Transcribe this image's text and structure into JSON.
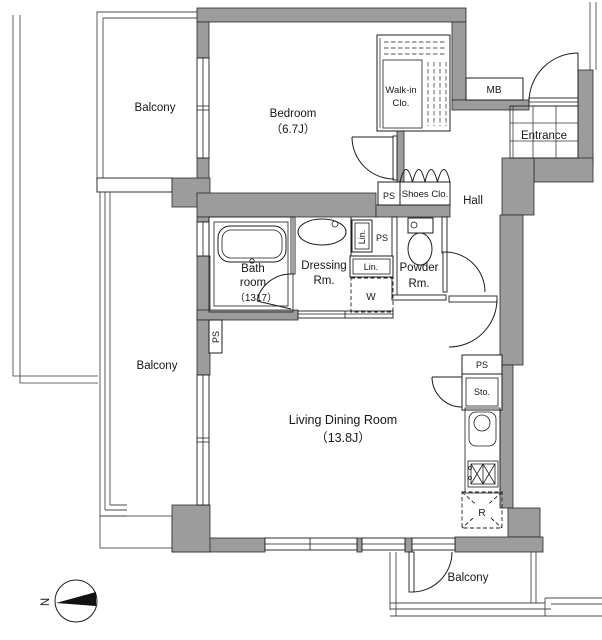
{
  "colors": {
    "wall_fill": "#9c9c9c",
    "line": "#1c1c1c",
    "background": "#ffffff",
    "compass_needle": "#111111"
  },
  "plan": {
    "balcony_top": "Balcony",
    "balcony_left": "Balcony",
    "balcony_bottom": "Balcony",
    "bedroom": {
      "name": "Bedroom",
      "size": "（6.7J）"
    },
    "living_dining": {
      "name": "Living Dining Room",
      "size": "（13.8J）"
    },
    "bath": {
      "line1": "Bath",
      "line2": "room",
      "line3": "（1317）"
    },
    "dressing": {
      "line1": "Dressing",
      "line2": "Rm."
    },
    "powder": {
      "line1": "Powder",
      "line2": "Rm."
    },
    "walkin": {
      "line1": "Walk-in",
      "line2": "Clo."
    },
    "entrance": "Entrance",
    "hall": "Hall",
    "shoes_clo": "Shoes Clo.",
    "mb": "MB",
    "ps_hall": "PS",
    "ps_dressing": "PS",
    "ps_left": "PS",
    "ps_kitchen": "PS",
    "lin_upper": "Lin.",
    "lin_lower": "Lin.",
    "washer": "W",
    "storage": "Sto.",
    "fridge": "R",
    "north": "N"
  }
}
